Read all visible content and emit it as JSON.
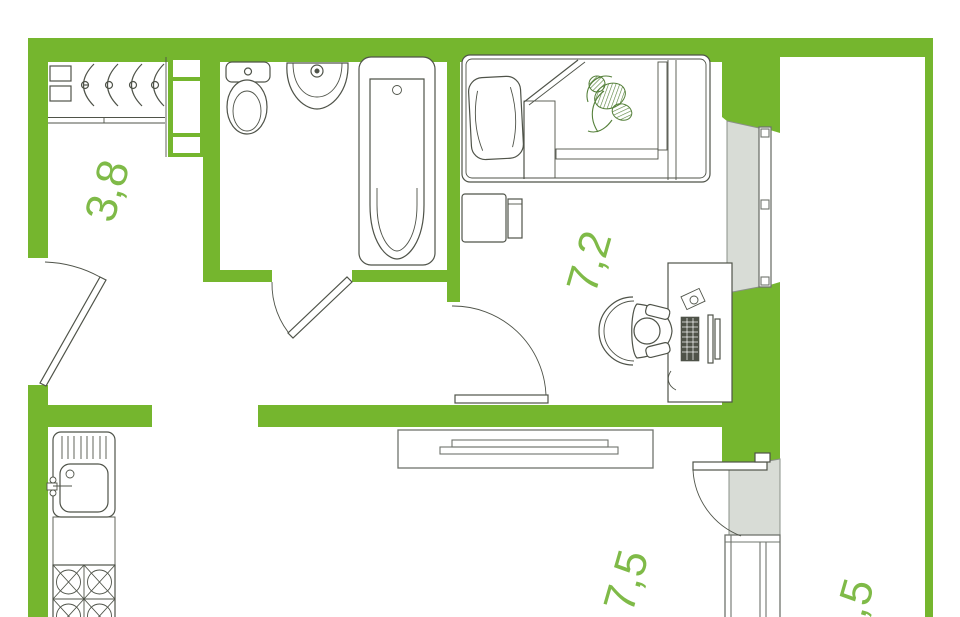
{
  "document": {
    "kind": "apartment-floor-plan"
  },
  "colors": {
    "wall": "#75b62e",
    "label": "#7fba48",
    "line": "#4f5349",
    "winfill": "#d8dcd6",
    "winborder": "#8a9088",
    "furniture_border": "#6f746d"
  },
  "rooms": {
    "hallway": {
      "label": "3,8"
    },
    "bedroom": {
      "label": "7,2"
    },
    "kitchen_living": {
      "label": "7,5"
    },
    "balcony": {
      "label": ",5"
    }
  },
  "fixtures": [
    "coat-rack",
    "ventilation-shaft",
    "toilet",
    "bathroom-sink",
    "bathtub",
    "single-bed",
    "pillow",
    "blanket-with-plant-motif",
    "nightstand",
    "desk",
    "desk-chair-with-person",
    "computer-keyboard",
    "monitor",
    "wardrobe",
    "kitchen-sink",
    "stove-4-burner",
    "entrance-door",
    "bathroom-door",
    "bedroom-door",
    "balcony-door",
    "bedroom-window",
    "living-room-window"
  ]
}
